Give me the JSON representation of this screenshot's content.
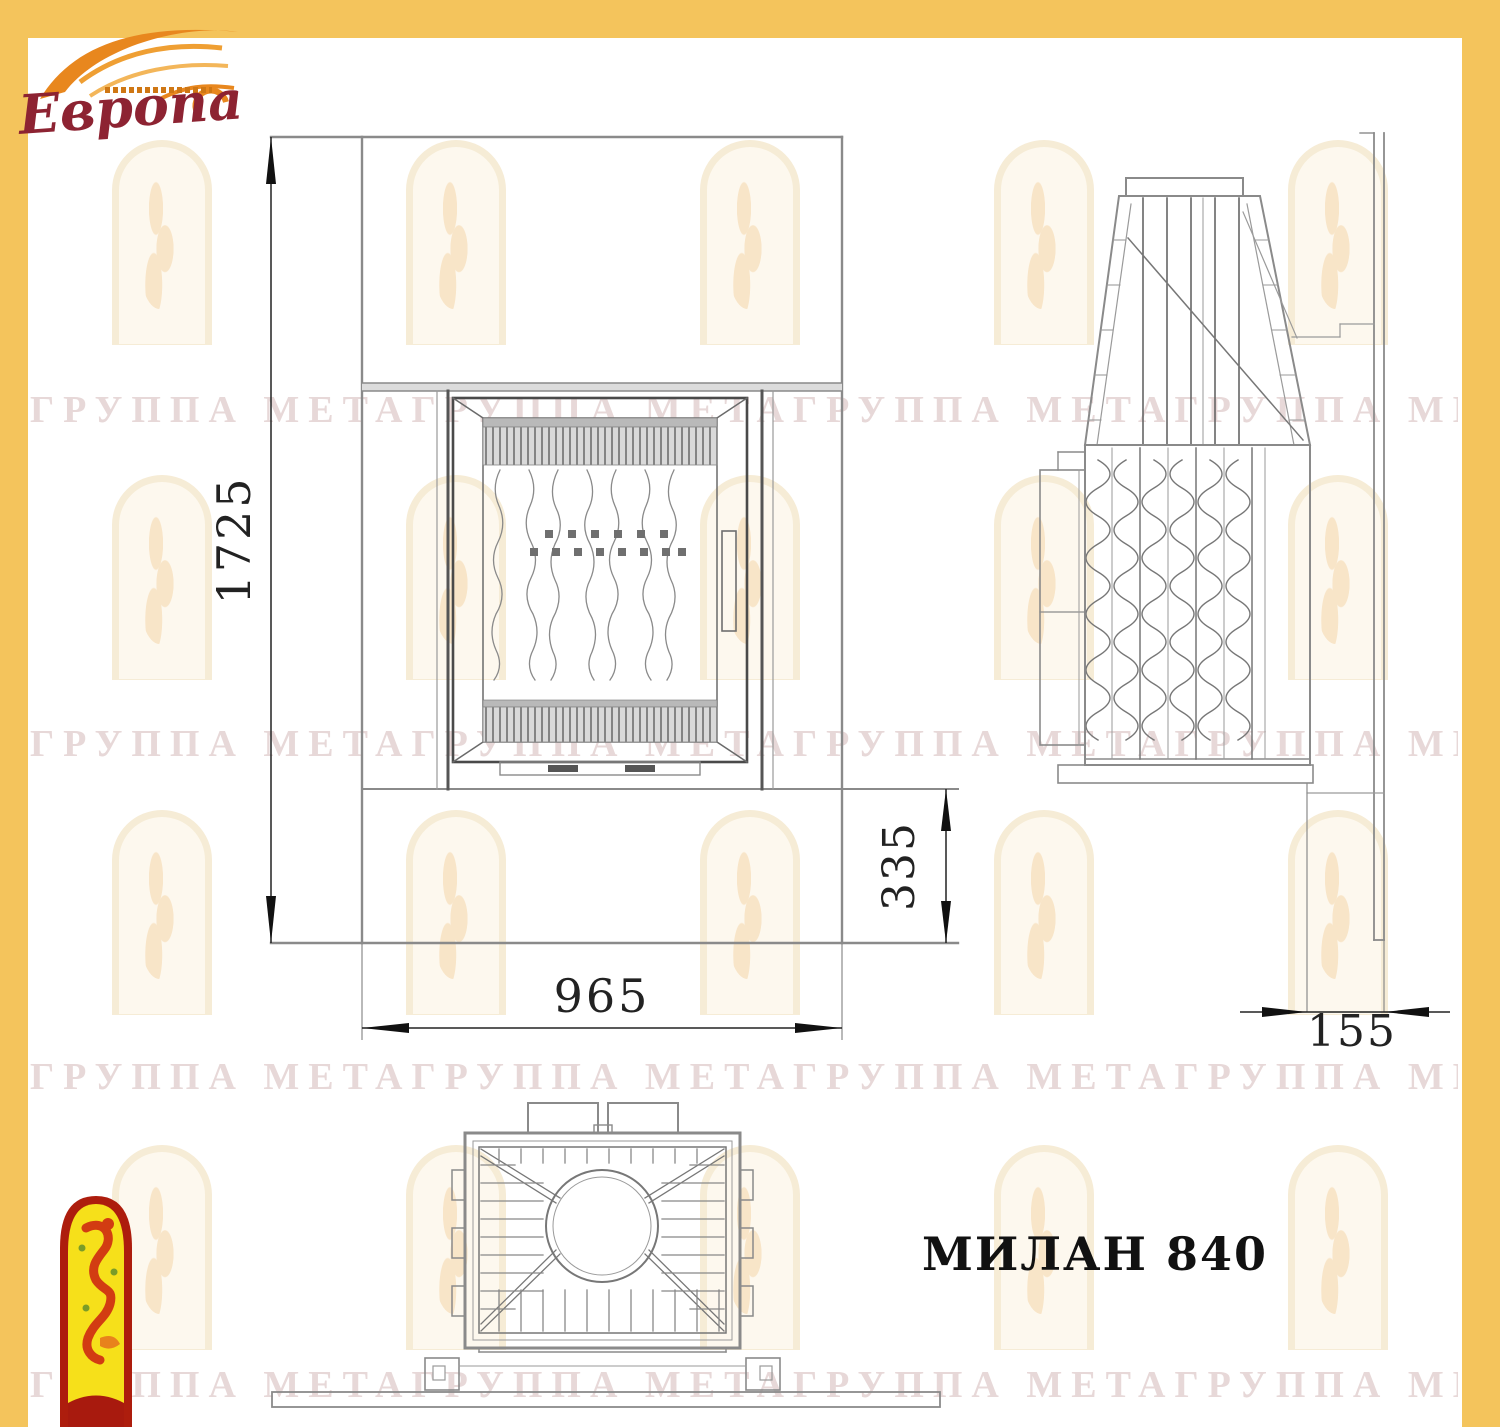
{
  "brand": {
    "name": "Европа"
  },
  "title": {
    "model": "МИЛАН 840"
  },
  "dimensions": {
    "front_height": "1725",
    "front_width": "965",
    "base_height": "335",
    "side_depth": "155"
  },
  "watermark": {
    "row_text": "ГРУППА МЕТАГРУППА МЕТАГРУППА МЕТАГРУППА МЕТА"
  },
  "icons": {
    "brand_flame": "flame-swoosh-icon",
    "bottom_left_emblem": "firebird-arch-icon"
  },
  "colors": {
    "frame_yellow": "#f4c45c",
    "logo_red": "#8d2332",
    "logo_orange": "#e8871e",
    "emblem_border_red": "#ad1d0d",
    "emblem_yellow": "#f6e01a",
    "drawing_line_gray": "#8a8a8a",
    "dimension_ink": "#222222",
    "watermark_text": "rgba(193,152,152,0.38)",
    "watermark_arch": "#f6ecd6"
  }
}
